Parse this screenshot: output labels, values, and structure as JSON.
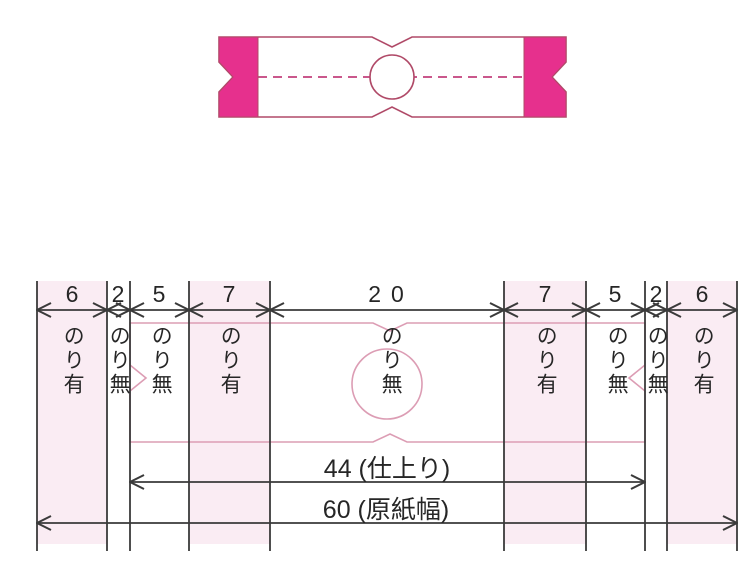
{
  "figure": {
    "description_labels": {
      "finished_width": "44 (仕上り)",
      "paper_width": "60 (原紙幅)"
    },
    "columns": [
      {
        "width": "6",
        "glue": "のり有",
        "shaded": true
      },
      {
        "width": "2",
        "glue": "のり無",
        "shaded": false
      },
      {
        "width": "5",
        "glue": "のり無",
        "shaded": false
      },
      {
        "width": "7",
        "glue": "のり有",
        "shaded": true
      },
      {
        "width": "20",
        "glue": "のり無",
        "shaded": false
      },
      {
        "width": "7",
        "glue": "のり有",
        "shaded": true
      },
      {
        "width": "5",
        "glue": "のり無",
        "shaded": false
      },
      {
        "width": "2",
        "glue": "のり無",
        "shaded": false
      },
      {
        "width": "6",
        "glue": "のり有",
        "shaded": true
      }
    ],
    "colors": {
      "magenta_fill": "#e6308d",
      "band_outline": "#b04a68",
      "fold_dash": "#c2407c",
      "guide_pink": "#dc9db4",
      "column_shading": "#faecf3",
      "line_dark": "#3a3a3a"
    }
  }
}
